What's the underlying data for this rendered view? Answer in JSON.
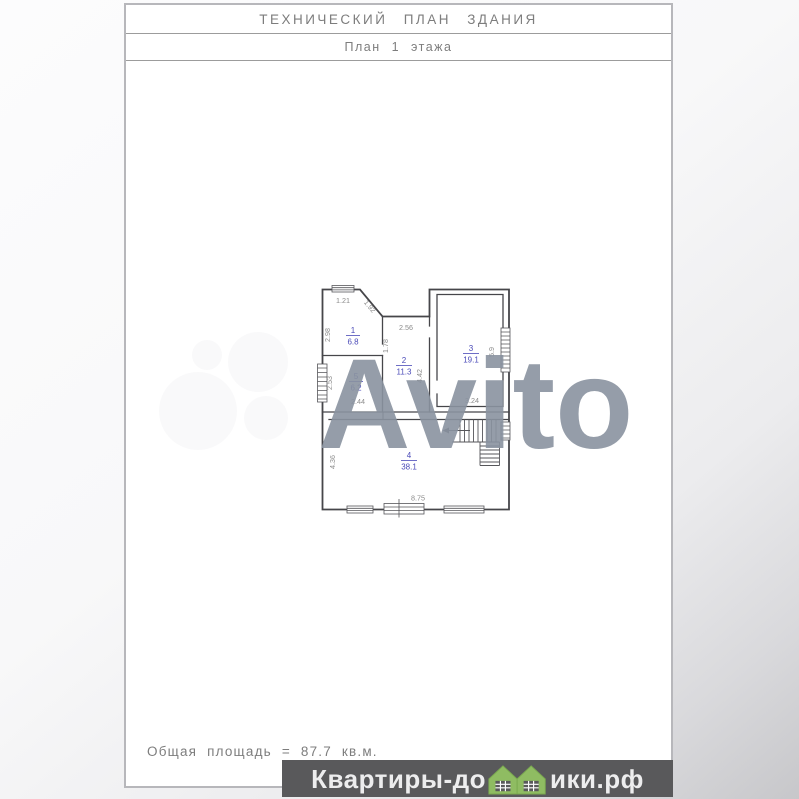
{
  "document": {
    "title": "ТЕХНИЧЕСКИЙ ПЛАН ЗДАНИЯ",
    "subtitle": "План 1 этажа",
    "total_area_note": "Общая площадь = 87.7 кв.м."
  },
  "plan": {
    "rooms": [
      {
        "number": "1",
        "area": "6.8"
      },
      {
        "number": "2",
        "area": "11.3"
      },
      {
        "number": "3",
        "area": "19.1"
      },
      {
        "number": "4",
        "area": "38.1"
      },
      {
        "number": "5",
        "area": "6.2"
      }
    ],
    "dimensions": [
      "1.21",
      "1.92",
      "2.98",
      "1.78",
      "2.56",
      "4.42",
      "5.9",
      "3.24",
      "2.53",
      "2.44",
      "4.36",
      "8.75"
    ],
    "stair_direction_icon": "left-arrow",
    "colors": {
      "room_label": "#4a4ab8",
      "dimension_text": "#8b8b8b",
      "wall_line": "#46464a"
    }
  },
  "watermarks": {
    "site_band": {
      "text_left": "Квартиры-до",
      "text_right": "ики.рф",
      "houses_icon": "green-houses",
      "background": "#59595b",
      "text_color": "#ededee",
      "house_color": "#8fbc62"
    },
    "background_logo_text": "Avito"
  }
}
